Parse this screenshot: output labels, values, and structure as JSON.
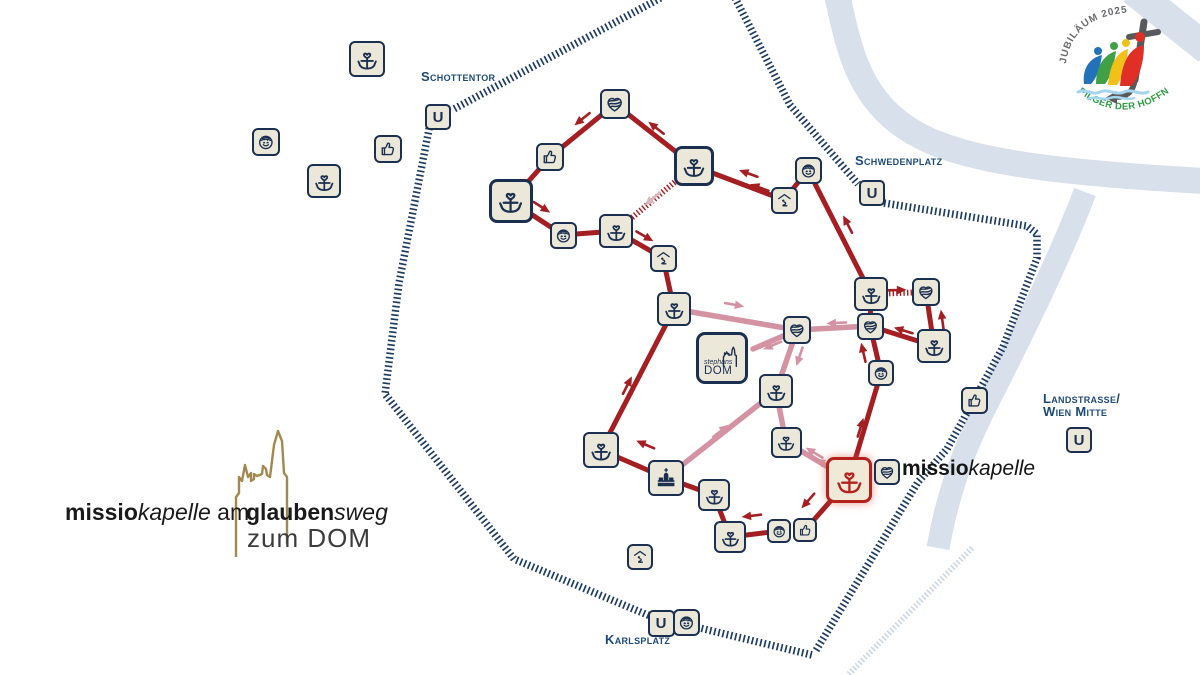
{
  "labels": {
    "u_station": "U",
    "schottentor": "Schottentor",
    "schwedenplatz": "Schwedenplatz",
    "karlsplatz": "Karlsplatz",
    "landstrasse_line1": "Landstrasse/",
    "landstrasse_line2": "Wien Mitte",
    "stephansdom_line1": "stephans",
    "stephansdom_line2": "DOM",
    "missiokapelle_bold": "missio",
    "missiokapelle_italic": "kapelle"
  },
  "footer_logo": {
    "bold1": "missio",
    "italic1": "kapelle",
    "regular1": " am",
    "bold2": "glauben",
    "italic2": "sweg",
    "line2": "zum DOM"
  },
  "jubilee": {
    "top": "JUBILÄUM 2025",
    "bottom": "PILGER DER HOFFNUNG"
  },
  "colors": {
    "red": "#a51e22",
    "pink": "#d493a2",
    "pale": "#d8b6bf",
    "ring": "#1f3d62",
    "river": "#d8e0ec",
    "river_hatch": "#c9d5e4",
    "navy": "#1b3050",
    "cream": "#ece8d9",
    "missio_red": "#b3221c",
    "gold": "#a3894f",
    "label_blue": "#1d4a78"
  },
  "map": {
    "stations": [
      {
        "t": "cross",
        "x": 367,
        "y": 59,
        "s": 36
      },
      {
        "t": "smiley",
        "x": 266,
        "y": 142,
        "s": 28
      },
      {
        "t": "cross",
        "x": 324,
        "y": 181,
        "s": 34
      },
      {
        "t": "thumb",
        "x": 388,
        "y": 149,
        "s": 28
      },
      {
        "t": "heart",
        "x": 615,
        "y": 104,
        "s": 30
      },
      {
        "t": "thumb",
        "x": 550,
        "y": 157,
        "s": 28
      },
      {
        "t": "cross",
        "x": 511,
        "y": 201,
        "s": 44
      },
      {
        "t": "smiley",
        "x": 563,
        "y": 235,
        "s": 27
      },
      {
        "t": "cross",
        "x": 616,
        "y": 231,
        "s": 34
      },
      {
        "t": "pray",
        "x": 663,
        "y": 258,
        "s": 27
      },
      {
        "t": "cross",
        "x": 694,
        "y": 166,
        "s": 40
      },
      {
        "t": "pray",
        "x": 784,
        "y": 200,
        "s": 27
      },
      {
        "t": "smiley",
        "x": 808,
        "y": 170,
        "s": 27
      },
      {
        "t": "cross",
        "x": 871,
        "y": 294,
        "s": 34
      },
      {
        "t": "heart",
        "x": 926,
        "y": 292,
        "s": 28
      },
      {
        "t": "heart",
        "x": 870,
        "y": 326,
        "s": 27
      },
      {
        "t": "cross",
        "x": 934,
        "y": 346,
        "s": 34
      },
      {
        "t": "smiley",
        "x": 881,
        "y": 373,
        "s": 26
      },
      {
        "t": "thumb",
        "x": 974,
        "y": 400,
        "s": 27
      },
      {
        "t": "cross",
        "x": 674,
        "y": 309,
        "s": 34
      },
      {
        "t": "heart",
        "x": 797,
        "y": 330,
        "s": 28
      },
      {
        "t": "dom",
        "x": 722,
        "y": 358,
        "s": 52
      },
      {
        "t": "cross",
        "x": 776,
        "y": 391,
        "s": 34
      },
      {
        "t": "cross",
        "x": 786,
        "y": 442,
        "s": 31
      },
      {
        "t": "cross",
        "x": 601,
        "y": 450,
        "s": 36
      },
      {
        "t": "church",
        "x": 666,
        "y": 478,
        "s": 36
      },
      {
        "t": "cross",
        "x": 714,
        "y": 495,
        "s": 32
      },
      {
        "t": "cross",
        "x": 849,
        "y": 480,
        "s": 46,
        "v": "missio"
      },
      {
        "t": "heart",
        "x": 887,
        "y": 472,
        "s": 26
      },
      {
        "t": "smiley",
        "x": 779,
        "y": 531,
        "s": 24
      },
      {
        "t": "thumb",
        "x": 805,
        "y": 530,
        "s": 24
      },
      {
        "t": "cross",
        "x": 730,
        "y": 537,
        "s": 32
      },
      {
        "t": "pray",
        "x": 640,
        "y": 557,
        "s": 26
      },
      {
        "t": "smiley",
        "x": 686,
        "y": 622,
        "s": 27
      },
      {
        "t": "u",
        "x": 438,
        "y": 117,
        "s": 26
      },
      {
        "t": "u",
        "x": 872,
        "y": 193,
        "s": 26
      },
      {
        "t": "u",
        "x": 1079,
        "y": 440,
        "s": 26
      },
      {
        "t": "u",
        "x": 661,
        "y": 623,
        "s": 27
      }
    ],
    "edges_red": [
      [
        615,
        104,
        550,
        157
      ],
      [
        550,
        157,
        511,
        201
      ],
      [
        511,
        201,
        563,
        235
      ],
      [
        563,
        235,
        616,
        231
      ],
      [
        616,
        231,
        663,
        258
      ],
      [
        663,
        258,
        674,
        309
      ],
      [
        615,
        104,
        694,
        166
      ],
      [
        694,
        166,
        784,
        200
      ],
      [
        784,
        200,
        808,
        170
      ],
      [
        808,
        170,
        871,
        294
      ],
      [
        871,
        294,
        870,
        326
      ],
      [
        934,
        346,
        870,
        326
      ],
      [
        934,
        346,
        926,
        292
      ],
      [
        870,
        326,
        881,
        373
      ],
      [
        881,
        373,
        849,
        480
      ],
      [
        849,
        480,
        805,
        530
      ],
      [
        779,
        531,
        730,
        537
      ],
      [
        730,
        537,
        714,
        495
      ],
      [
        714,
        495,
        666,
        478
      ],
      [
        666,
        478,
        601,
        450
      ],
      [
        601,
        450,
        674,
        309
      ]
    ],
    "edges_pink": [
      [
        674,
        309,
        797,
        330
      ],
      [
        797,
        330,
        753,
        349
      ],
      [
        797,
        330,
        776,
        391
      ],
      [
        776,
        391,
        786,
        442
      ],
      [
        776,
        391,
        672,
        473
      ],
      [
        786,
        442,
        843,
        476
      ],
      [
        870,
        326,
        797,
        330
      ]
    ],
    "edges_dotted": [
      [
        694,
        166,
        616,
        231
      ],
      [
        871,
        294,
        926,
        292
      ]
    ],
    "arrows": [
      [
        581,
        120,
        141,
        "r"
      ],
      [
        543,
        208,
        33,
        "r"
      ],
      [
        646,
        237,
        30,
        "r"
      ],
      [
        655,
        127,
        218,
        "r"
      ],
      [
        747,
        173,
        200,
        "r"
      ],
      [
        758,
        187,
        200,
        "r"
      ],
      [
        847,
        223,
        243,
        "r"
      ],
      [
        628,
        384,
        -63,
        "r"
      ],
      [
        863,
        351,
        -103,
        "r"
      ],
      [
        942,
        318,
        -98,
        "r"
      ],
      [
        902,
        330,
        197,
        "r"
      ],
      [
        861,
        426,
        -73,
        "r"
      ],
      [
        807,
        502,
        131,
        "r"
      ],
      [
        750,
        516,
        173,
        "r"
      ],
      [
        644,
        444,
        203,
        "r"
      ],
      [
        898,
        290,
        -2,
        "r"
      ],
      [
        736,
        305,
        10,
        "p"
      ],
      [
        771,
        346,
        157,
        "p"
      ],
      [
        835,
        323,
        177,
        "p"
      ],
      [
        799,
        358,
        109,
        "p"
      ],
      [
        722,
        430,
        -38,
        "p"
      ],
      [
        813,
        452,
        211,
        "p"
      ],
      [
        823,
        463,
        211,
        "p"
      ],
      [
        651,
        200,
        140,
        "pp"
      ]
    ],
    "ring": [
      [
        [
          668,
          -6
        ],
        [
          452,
          110
        ]
      ],
      [
        [
          430,
          124
        ],
        [
          399,
          283
        ],
        [
          385,
          394
        ],
        [
          514,
          559
        ],
        [
          650,
          616
        ],
        [
          812,
          655
        ]
      ],
      [
        [
          733,
          -6
        ],
        [
          790,
          105
        ],
        [
          858,
          184
        ]
      ],
      [
        [
          884,
          203
        ],
        [
          1027,
          226
        ],
        [
          1037,
          234
        ],
        [
          1037,
          258
        ],
        [
          1003,
          347
        ],
        [
          974,
          400
        ],
        [
          947,
          449
        ],
        [
          918,
          482
        ],
        [
          815,
          652
        ]
      ]
    ],
    "hatch_light": [
      [
        [
          972,
          548
        ],
        [
          848,
          675
        ]
      ]
    ],
    "rivers": [
      {
        "d": "M836,-10 C848,45 856,85 892,117 C935,155 1010,170 1205,181",
        "w": 26
      },
      {
        "d": "M1085,192 C1058,262 1026,326 998,382 C976,425 952,470 938,548",
        "w": 23
      },
      {
        "d": "M1133,-10 L1208,50",
        "w": 30
      }
    ]
  }
}
